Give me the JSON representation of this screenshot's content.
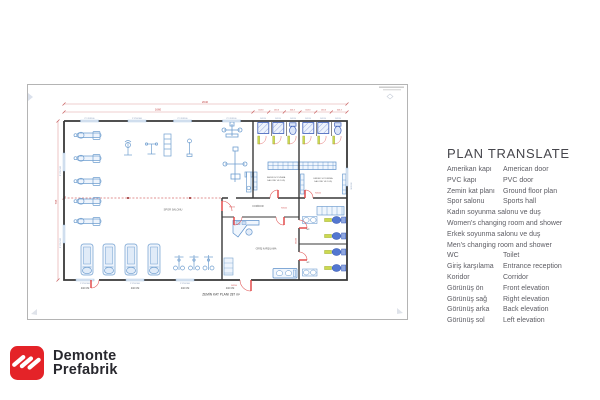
{
  "plan": {
    "title": "ZEMİN KAT PLANI 287 m²",
    "rooms": {
      "gym": "SPOR SALONU",
      "women1": "KADIN SOYUNMA",
      "women2": "SALONU VE DUŞ",
      "men1": "ERKEK SOYUNMA",
      "men2": "SALONU VE DUŞ",
      "corridor": "KORİDOR",
      "reception": "GİRİŞ KARŞILAMA",
      "wc": "wc"
    },
    "dims": {
      "total": "2640",
      "gym_width": "1660",
      "stall": "163.3",
      "left_height": "795",
      "bottom": "440 CM"
    },
    "labels": {
      "window": "P 170X100",
      "shower_door": "90X190",
      "door": "90X200"
    }
  },
  "translate": {
    "heading": "PLAN TRANSLATE",
    "rows": [
      {
        "tr": "Amerikan kapı",
        "en": "American door"
      },
      {
        "tr": "PVC kapı",
        "en": "PVC door"
      },
      {
        "tr": "Zemin kat planı",
        "en": "Ground floor plan"
      },
      {
        "tr": "Spor salonu",
        "en": "Sports hall"
      },
      {
        "text": "Kadın soyunma salonu ve duş"
      },
      {
        "text": "Women's changing room and shower"
      },
      {
        "text": "Erkek soyunma salonu ve duş"
      },
      {
        "text": "Men's changing room and shower"
      },
      {
        "tr": "WC",
        "en": "Toilet"
      },
      {
        "tr": "Giriş karşılama",
        "en": "Entrance reception"
      },
      {
        "tr": "Koridor",
        "en": "Corridor"
      },
      {
        "tr": "Görünüş ön",
        "en": "Front elevation"
      },
      {
        "tr": "Görünüş sağ",
        "en": "Right elevation"
      },
      {
        "tr": "Görünüş arka",
        "en": "Back elevation"
      },
      {
        "tr": "Görünüş sol",
        "en": "Left elevation"
      }
    ]
  },
  "logo": {
    "line1": "Demonte",
    "line2": "Prefabrik",
    "brand_red": "#e42328"
  }
}
